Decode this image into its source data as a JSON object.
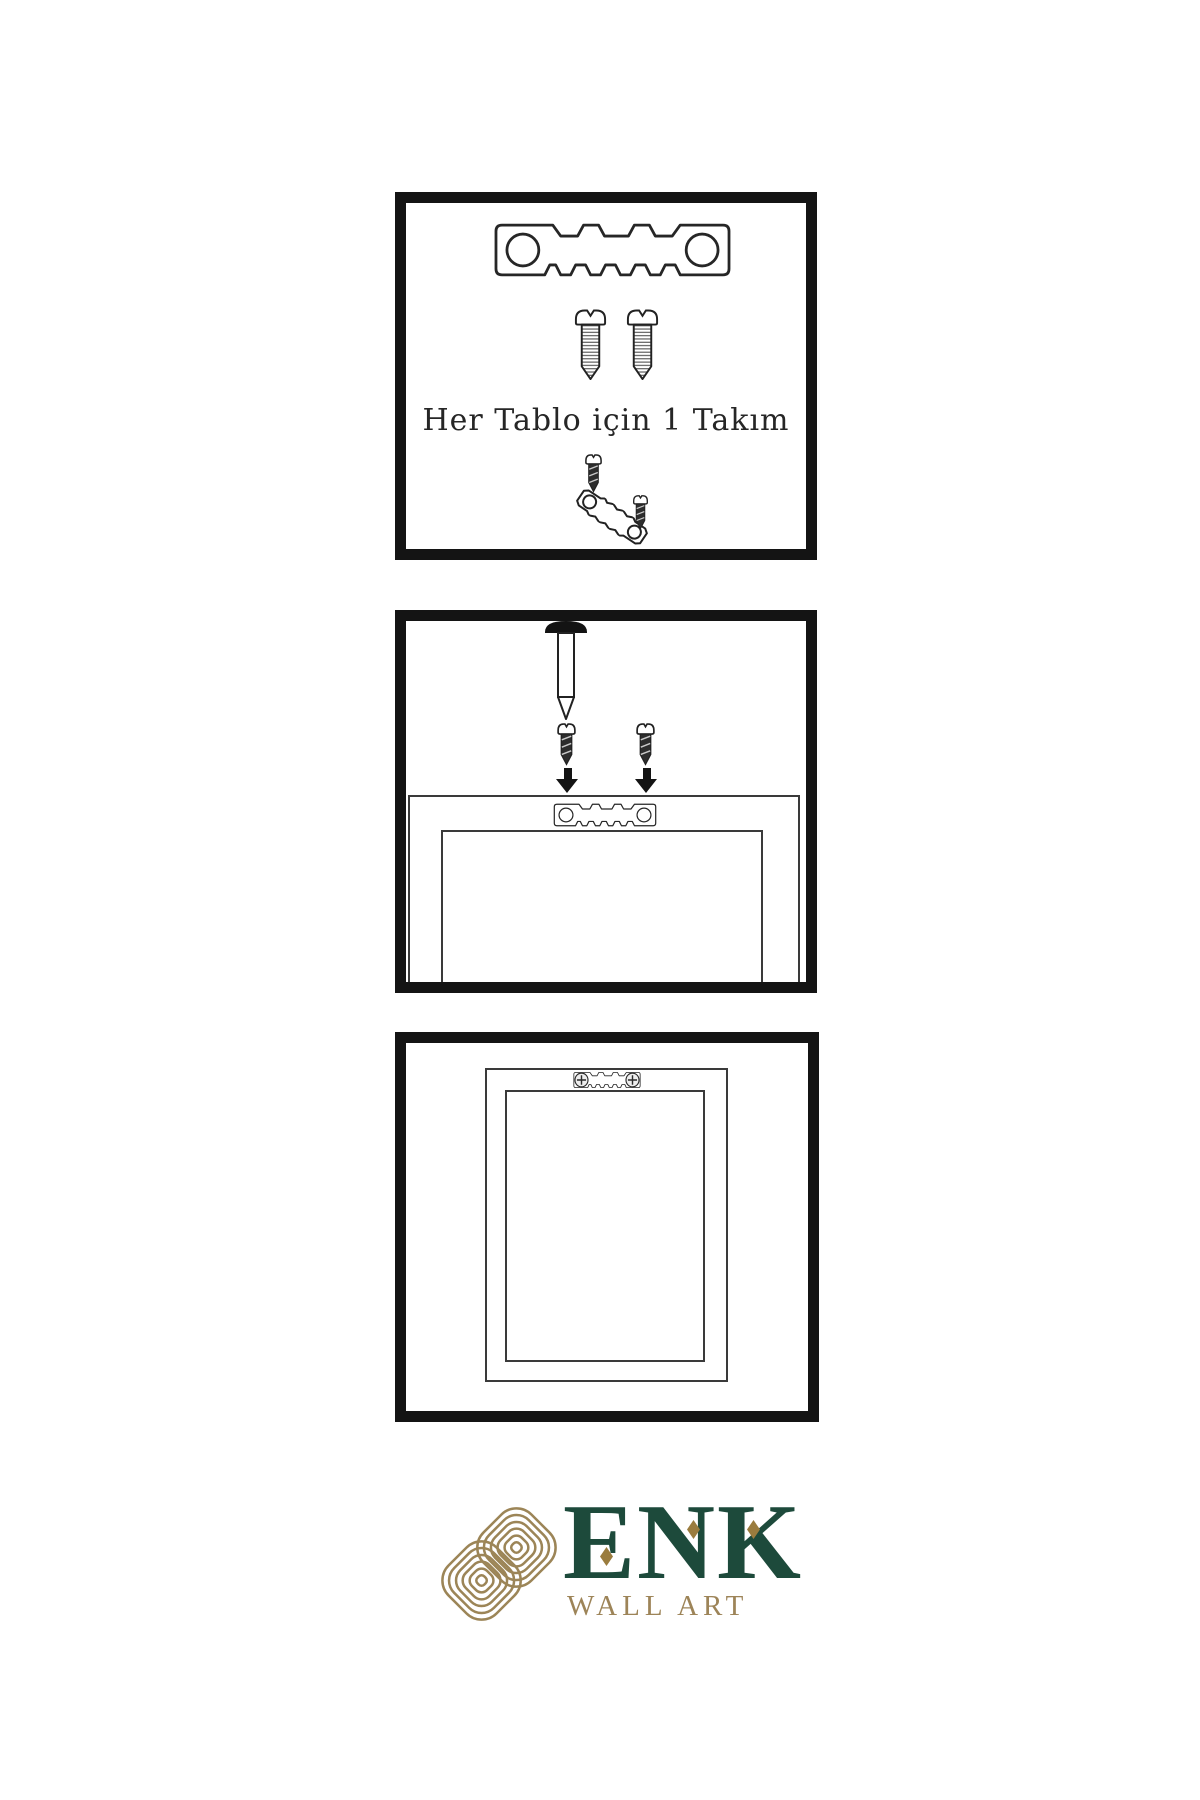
{
  "page": {
    "background": "#ffffff"
  },
  "kit": {
    "label": "Her Tablo için 1 Takım"
  },
  "brand": {
    "name": "ENK",
    "tagline": "WALL ART"
  },
  "colors": {
    "panel_border": "#141414",
    "line_art": "#262626",
    "frame_line": "#3a3a3a",
    "screw_dark_fill": "#2d2d2d",
    "nail_head": "#131313",
    "arrow": "#141414",
    "brand_green": "#1d4a3b",
    "brand_gold": "#9c8557",
    "diamond_gold": "#9a7c3e"
  },
  "panels": [
    {
      "name": "hardware-kit-panel",
      "icons": [
        "sawtooth-hanger-icon",
        "screw-icon",
        "screw-icon",
        "small-screw-icon",
        "tilted-sawtooth-hanger-icon",
        "small-screw-icon"
      ]
    },
    {
      "name": "mounting-panel",
      "icons": [
        "nail-icon",
        "dark-screw-icon",
        "dark-screw-icon",
        "down-arrow-icon",
        "down-arrow-icon",
        "sawtooth-hanger-icon",
        "frame-back-outline"
      ]
    },
    {
      "name": "hung-frame-panel",
      "icons": [
        "mounted-sawtooth-hanger-icon",
        "frame-outline"
      ]
    }
  ],
  "logo": {
    "mark": "knot-icon"
  }
}
